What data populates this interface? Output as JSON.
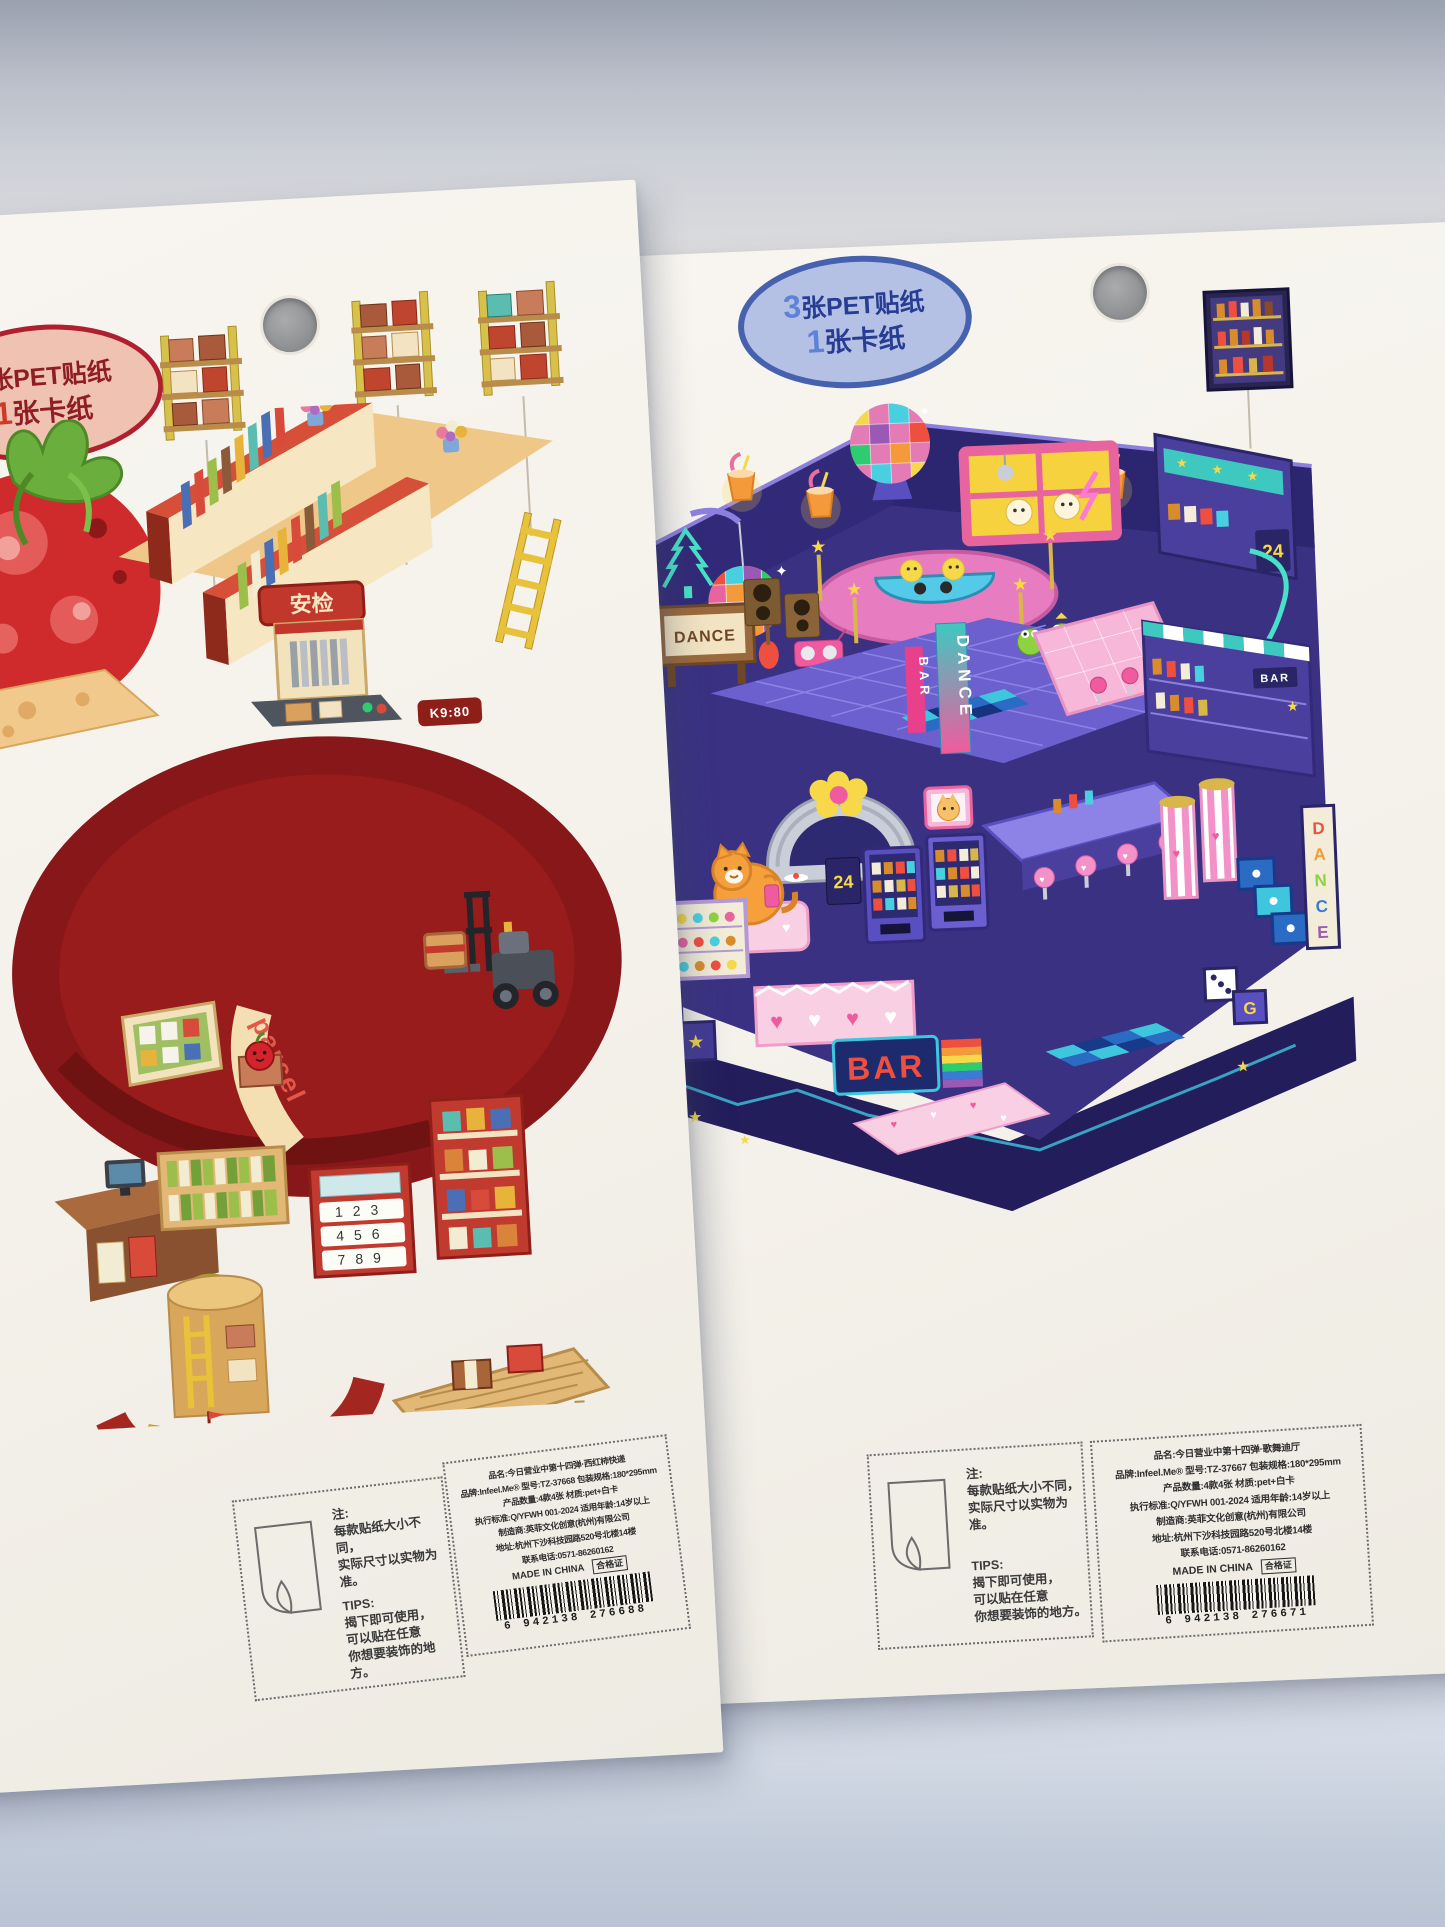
{
  "left": {
    "badge": {
      "num1": "3",
      "txt1": "张PET贴纸",
      "num2": "1",
      "txt2": "张卡纸"
    },
    "note": {
      "title": "注:",
      "l1": "每款贴纸大小不同，",
      "l2": "实际尺寸以实物为准。"
    },
    "tips": {
      "title": "TIPS:",
      "l1": "揭下即可使用，",
      "l2": "可以贴在任意",
      "l3": "你想要装饰的地方。"
    },
    "product": {
      "lines": [
        "品名:今日营业中第十四弹·西红柿快递",
        "品牌:Infeel.Me® 型号:TZ-37668 包装规格:180*295mm",
        "产品数量:4款4张 材质:pet+白卡",
        "执行标准:Q/YFWH 001-2024 适用年龄:14岁以上",
        "制造商:英菲文化创意(杭州)有限公司",
        "地址:杭州下沙科技园路520号北楼14楼",
        "联系电话:0571-86260162"
      ],
      "origin": "MADE IN CHINA",
      "cert": "合格证",
      "barcode": "6 942138 276688"
    },
    "art": {
      "security": "安检",
      "parcel": "parcel",
      "register": "K9:80",
      "keypad": [
        "123",
        "456",
        "789"
      ]
    }
  },
  "right": {
    "badge": {
      "num1": "3",
      "txt1": "张PET贴纸",
      "num2": "1",
      "txt2": "张卡纸"
    },
    "note": {
      "title": "注:",
      "l1": "每款贴纸大小不同，",
      "l2": "实际尺寸以实物为准。"
    },
    "tips": {
      "title": "TIPS:",
      "l1": "揭下即可使用，",
      "l2": "可以贴在任意",
      "l3": "你想要装饰的地方。"
    },
    "product": {
      "lines": [
        "品名:今日营业中第十四弹·歌舞迪厅",
        "品牌:Infeel.Me® 型号:TZ-37667 包装规格:180*295mm",
        "产品数量:4款4张 材质:pet+白卡",
        "执行标准:Q/YFWH 001-2024 适用年龄:14岁以上",
        "制造商:英菲文化创意(杭州)有限公司",
        "地址:杭州下沙科技园路520号北楼14楼",
        "联系电话:0571-86260162"
      ],
      "origin": "MADE IN CHINA",
      "cert": "合格证",
      "barcode": "6 942138 276671"
    },
    "art": {
      "dance": "DANCE",
      "bar": "BAR",
      "bar2": "BAR",
      "dancev": "DANCE",
      "hours": "24",
      "g": "G",
      "rainbow": [
        "D",
        "A",
        "N",
        "C",
        "E"
      ]
    }
  },
  "icons": {
    "star": "★",
    "heart": "♥",
    "music_note": "♪",
    "sparkle": "✦"
  },
  "colors": {
    "left_accent": "#c0392b",
    "left_mat": "#871718",
    "right_accent": "#37307e",
    "badge_left_border": "#b01f2e",
    "badge_right_border": "#4662ae",
    "floor": "#c5cede"
  }
}
